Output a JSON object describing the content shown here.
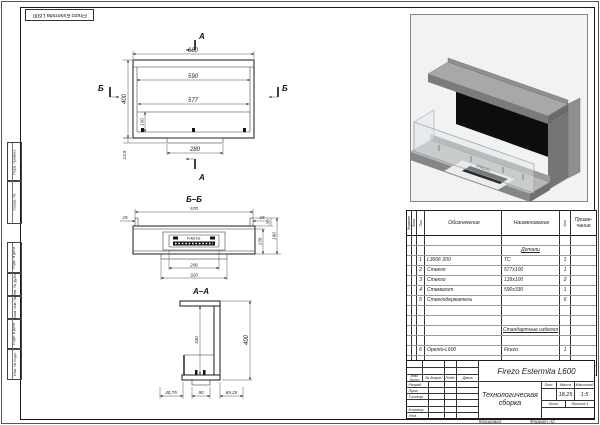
{
  "page": {
    "top_stamp": "Firezo Estermita L600"
  },
  "margin_labels": [
    "Перв. примен.",
    "Справ. №",
    "Подп. и дата",
    "Инв. № дубл.",
    "Взам. инв. №",
    "Подп. и дата",
    "Инв. № подл."
  ],
  "views": {
    "plan": {
      "section_a": "А",
      "section_b": "Б",
      "dim_680": "680",
      "dim_590": "590",
      "dim_577": "577",
      "dim_280": "280",
      "dim_400": "400",
      "dim_100": "100",
      "dim_135": "13,5"
    },
    "section_bb": {
      "title": "Б–Б",
      "dim_570": "570",
      "dim_15l": "15",
      "dim_15r": "15",
      "dim_30": "30",
      "dim_139": "139",
      "dim_160": "160",
      "dim_206": "206",
      "dim_320": "320",
      "burner_logo": "FIREZO"
    },
    "section_aa": {
      "title": "А–А",
      "dim_330": "330",
      "dim_400": "400",
      "dim_4075": "40,75",
      "dim_90": "90",
      "dim_6925": "69,25"
    }
  },
  "iso": {
    "logo": "FIREZO"
  },
  "spec_table": {
    "col_format": "Формат",
    "col_zone": "Зона",
    "col_pos": "Поз.",
    "col_designation": "Обозначение",
    "col_name": "Наименование",
    "col_qty": "Кол.",
    "col_note_line1": "Приме-",
    "col_note_line2": "чание",
    "section_details": "Детали",
    "section_standard": "Стандартные изделия",
    "rows": [
      {
        "pos": "1",
        "designation": "L300F 200",
        "name": "ТС",
        "qty": "1"
      },
      {
        "pos": "2",
        "designation": "Стекло",
        "name": "577х100",
        "qty": "1"
      },
      {
        "pos": "3",
        "designation": "Стекло",
        "name": "139х100",
        "qty": "2"
      },
      {
        "pos": "4",
        "designation": "Стемалит",
        "name": "590х330",
        "qty": "1"
      },
      {
        "pos": "5",
        "designation": "Стеклодержатель",
        "name": "",
        "qty": "6"
      },
      {
        "pos": "6",
        "designation": "Opento-L600",
        "name": "Firezo",
        "qty": "1"
      }
    ]
  },
  "title_block": {
    "designation": "Firezo Estermita L600",
    "doc_title": "Технологическая сборка",
    "lit_label": "Лит.",
    "mass_label": "Масса",
    "scale_label": "Масштаб",
    "mass_value": "18,25",
    "scale_value": "1:5",
    "sheet_label": "Лист",
    "sheets_label": "Листов",
    "sheets_value": "1",
    "hdr_izm": "Изм.",
    "hdr_list": "Лист",
    "hdr_doc": "№ докум.",
    "hdr_podp": "Подп.",
    "hdr_data": "Дата",
    "role_razrab": "Разраб.",
    "role_prov": "Пров.",
    "role_tkontr": "Т.контр.",
    "role_nkontr": "Н.контр.",
    "role_utv": "Утв.",
    "footer_copied": "Копировал",
    "footer_format_label": "Формат",
    "footer_format_value": "А2"
  }
}
